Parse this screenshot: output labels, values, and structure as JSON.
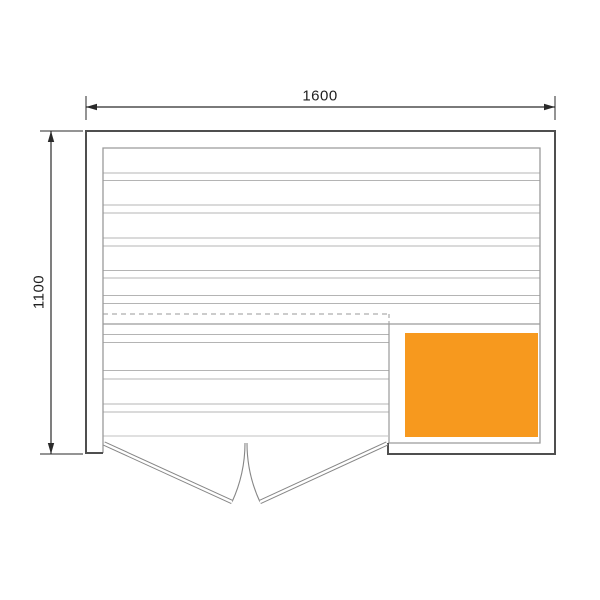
{
  "drawing": {
    "type": "floor-plan-technical-drawing",
    "dimension_width_label": "1600",
    "dimension_height_label": "1100",
    "colors": {
      "background": "#ffffff",
      "wall_outline": "#4f4f4f",
      "panel_line": "#9a9a9a",
      "board_line": "#b4b4b4",
      "hidden_edge": "#9a9a9a",
      "threshold": "#c2c2c2",
      "door_line": "#868686",
      "door_gap": "#ffffff",
      "dimension": "#2a2a2a",
      "heater_fill": "#F7991E"
    },
    "geometry": {
      "outer": {
        "left": 86,
        "top": 131,
        "right": 555,
        "bottom": 454
      },
      "inner": {
        "left": 103,
        "top": 148,
        "right": 540,
        "bottom": 443
      },
      "left_wall_cap_y": 453,
      "opening": {
        "left": 103,
        "right": 388
      },
      "wall_boards_y": [
        173,
        180.5,
        205,
        213,
        238,
        246,
        270.5,
        278,
        295.5,
        303.5
      ],
      "bench_boards_y": [
        334.5,
        342.5,
        370.5,
        379,
        404,
        412
      ],
      "hidden_edge_y": 314,
      "bench_front_edge_y": 324,
      "partition_x": 389,
      "threshold_y": 436,
      "heater": {
        "x": 405,
        "y": 333,
        "w": 133,
        "h": 104
      },
      "door_left": {
        "hinge_x": 104,
        "hinge_y": 443.5,
        "tip_x": 232,
        "tip_y": 502
      },
      "door_right": {
        "hinge_x": 387,
        "hinge_y": 443.5,
        "tip_x": 260,
        "tip_y": 502
      },
      "arc_left": "M 245 443 A 141 141 0 0 1 232 502",
      "arc_right": "M 247 443 A 140 140 0 0 0 260 502",
      "dim_top": {
        "y": 107,
        "x1": 86,
        "x2": 555,
        "ext_y1": 96,
        "ext_y2": 120
      },
      "dim_left": {
        "x": 51,
        "y1": 131,
        "y2": 454,
        "ext_x1": 40,
        "ext_x2": 83
      },
      "arrow_len": 11,
      "arrow_half_w": 3.2
    }
  }
}
